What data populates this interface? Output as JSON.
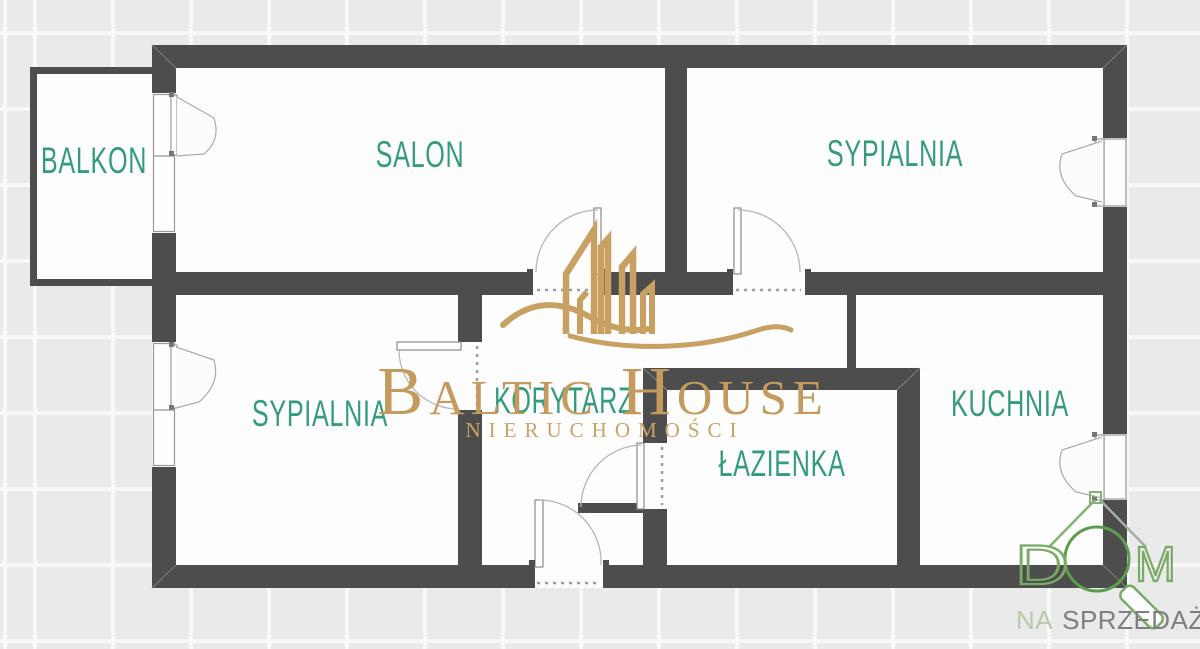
{
  "floorplan": {
    "rooms": [
      {
        "id": "balkon",
        "label": "BALKON"
      },
      {
        "id": "salon",
        "label": "SALON"
      },
      {
        "id": "sypialnia_top",
        "label": "SYPIALNIA"
      },
      {
        "id": "sypialnia_left",
        "label": "SYPIALNIA"
      },
      {
        "id": "korytarz",
        "label": "KORYTARZ"
      },
      {
        "id": "lazienka",
        "label": "ŁAZIENKA"
      },
      {
        "id": "kuchnia",
        "label": "KUCHNIA"
      }
    ],
    "colors": {
      "wall": "#4d4d4d",
      "floor": "#fdfdfd",
      "room_label": "#359b7e",
      "brand_gold": "#c8a162",
      "logo_green": "#79ab66",
      "tagline_na": "#b7cbac",
      "tagline_gray": "#7c7f81"
    },
    "icons": {
      "building": "baltic-house-building-icon",
      "house_magnifier": "dom-house-magnifier-icon"
    }
  },
  "watermark": {
    "brand_word1": "BALTIC",
    "brand_word2": "HOUSE",
    "subtitle": "NIERUCHOMOŚCI"
  },
  "agency_logo": {
    "letter_d": "D",
    "letter_m": "M",
    "tagline_prefix": "NA",
    "tagline_main": "SPRZEDAŻ"
  }
}
